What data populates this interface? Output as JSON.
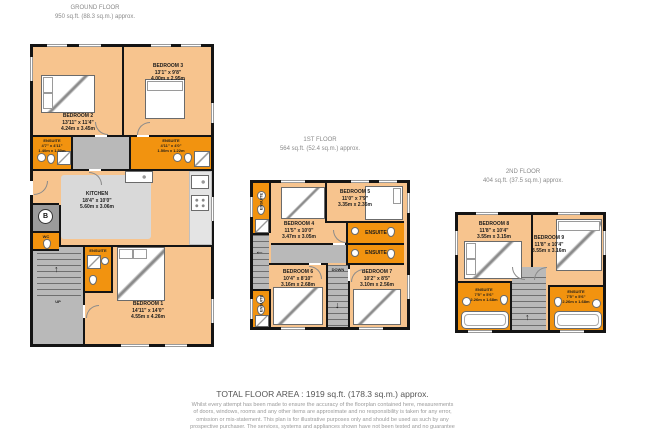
{
  "floors": {
    "ground": {
      "title": "GROUND FLOOR",
      "area": "950 sq.ft. (88.3 sq.m.) approx.",
      "rooms": {
        "bedroom2": {
          "name": "BEDROOM 2",
          "ft": "13'11\" x 11'4\"",
          "m": "4.24m x 3.45m"
        },
        "bedroom3": {
          "name": "BEDROOM 3",
          "ft": "13'1\" x 9'8\"",
          "m": "4.00m x 2.95m"
        },
        "ensuite2": {
          "name": "ENSUITE",
          "ft": "4'7\" x 4'11\"",
          "m": "1.40m x 1.50m"
        },
        "ensuite3": {
          "name": "ENSUITE",
          "ft": "4'11\" x 4'0\"",
          "m": "1.50m x 1.22m"
        },
        "kitchen": {
          "name": "KITCHEN",
          "ft": "18'4\" x 10'0\"",
          "m": "5.60m x 3.06m"
        },
        "bedroom1": {
          "name": "BEDROOM 1",
          "ft": "14'11\" x 14'0\"",
          "m": "4.55m x 4.26m"
        },
        "ensuite1": {
          "name": "ENSUITE"
        },
        "wc": {
          "name": "WC"
        },
        "boiler": {
          "label": "B"
        },
        "up": "UP"
      }
    },
    "first": {
      "title": "1ST FLOOR",
      "area": "564 sq.ft. (52.4 sq.m.) approx.",
      "rooms": {
        "bedroom4": {
          "name": "BEDROOM 4",
          "ft": "11'5\" x 10'0\"",
          "m": "3.47m x 3.05m"
        },
        "bedroom5": {
          "name": "BEDROOM 5",
          "ft": "11'0\" x 7'9\"",
          "m": "3.35m x 2.35m"
        },
        "bedroom6": {
          "name": "BEDROOM 6",
          "ft": "10'4\" x 8'10\"",
          "m": "3.16m x 2.68m"
        },
        "bedroom7": {
          "name": "BEDROOM 7",
          "ft": "10'2\" x 8'5\"",
          "m": "3.10m x 2.56m"
        },
        "ensuite4": {
          "name": "ENSUITE"
        },
        "ensuite5": {
          "name": "ENSUITE"
        },
        "ensuite6": {
          "name": "ENSUITE"
        },
        "ensuite7": {
          "name": "ENSUITE"
        },
        "down": "DOWN"
      }
    },
    "second": {
      "title": "2ND FLOOR",
      "area": "404 sq.ft. (37.5 sq.m.) approx.",
      "rooms": {
        "bedroom8": {
          "name": "BEDROOM 8",
          "ft": "11'8\" x 10'4\"",
          "m": "3.55m x 3.15m"
        },
        "bedroom9": {
          "name": "BEDROOM 9",
          "ft": "11'8\" x 10'4\"",
          "m": "3.55m x 3.16m"
        },
        "ensuite8": {
          "name": "ENSUITE",
          "ft": "7'5\" x 5'6\"",
          "m": "2.26m x 1.68m"
        },
        "ensuite9": {
          "name": "ENSUITE",
          "ft": "7'5\" x 5'6\"",
          "m": "2.26m x 1.68m"
        }
      }
    }
  },
  "footer": {
    "total": "TOTAL FLOOR AREA : 1919 sq.ft. (178.3 sq.m.) approx.",
    "disclaimer": [
      "Whilst every attempt has been made to ensure the accuracy of the floorplan contained here, measurements",
      "of doors, windows, rooms and any other items are approximate and no responsibility is taken for any error,",
      "omission or mis-statement. This plan is for illustrative purposes only and should be used as such by any",
      "prospective purchaser. The services, systems and appliances shown have not been tested and no guarantee"
    ]
  },
  "colors": {
    "room_fill": "#f7c48e",
    "wet_room_fill": "#f2930f",
    "hall_fill": "#b9b9b9",
    "wall": "#141414"
  }
}
